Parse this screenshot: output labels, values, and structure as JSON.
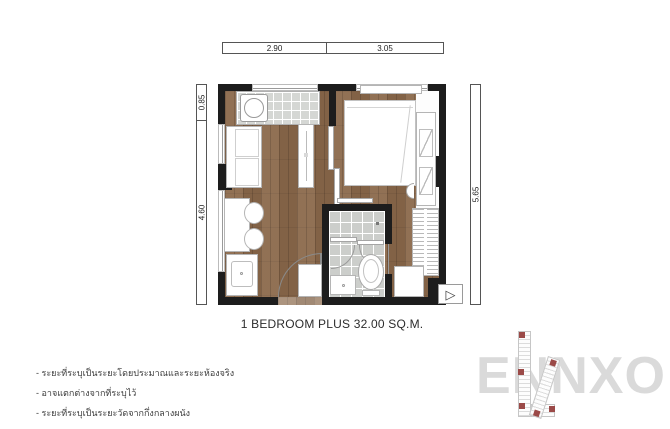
{
  "title": "1 BEDROOM PLUS 32.00 SQ.M.",
  "dimensions": {
    "top": [
      "2.90",
      "3.05"
    ],
    "left": [
      "0.85",
      "4.60"
    ],
    "right": [
      "5.65"
    ]
  },
  "notes": [
    "- ระยะที่ระบุเป็นระยะโดยประมาณและระยะห้องจริง",
    "- อาจแตกต่างจากที่ระบุไว้",
    "- ระยะที่ระบุเป็นระยะวัดจากกึ่งกลางผนัง"
  ],
  "watermark": "ENNXO",
  "icons": {
    "ac_marker": "▷"
  },
  "colors": {
    "wall": "#1d1d1d",
    "wood_floor": "#8a684a",
    "bathroom_tile": "#cccecb",
    "kitchen_counter": "#d5d7d4",
    "site_marker_red": "#9b4a48",
    "watermark_gray": "#dadada"
  }
}
